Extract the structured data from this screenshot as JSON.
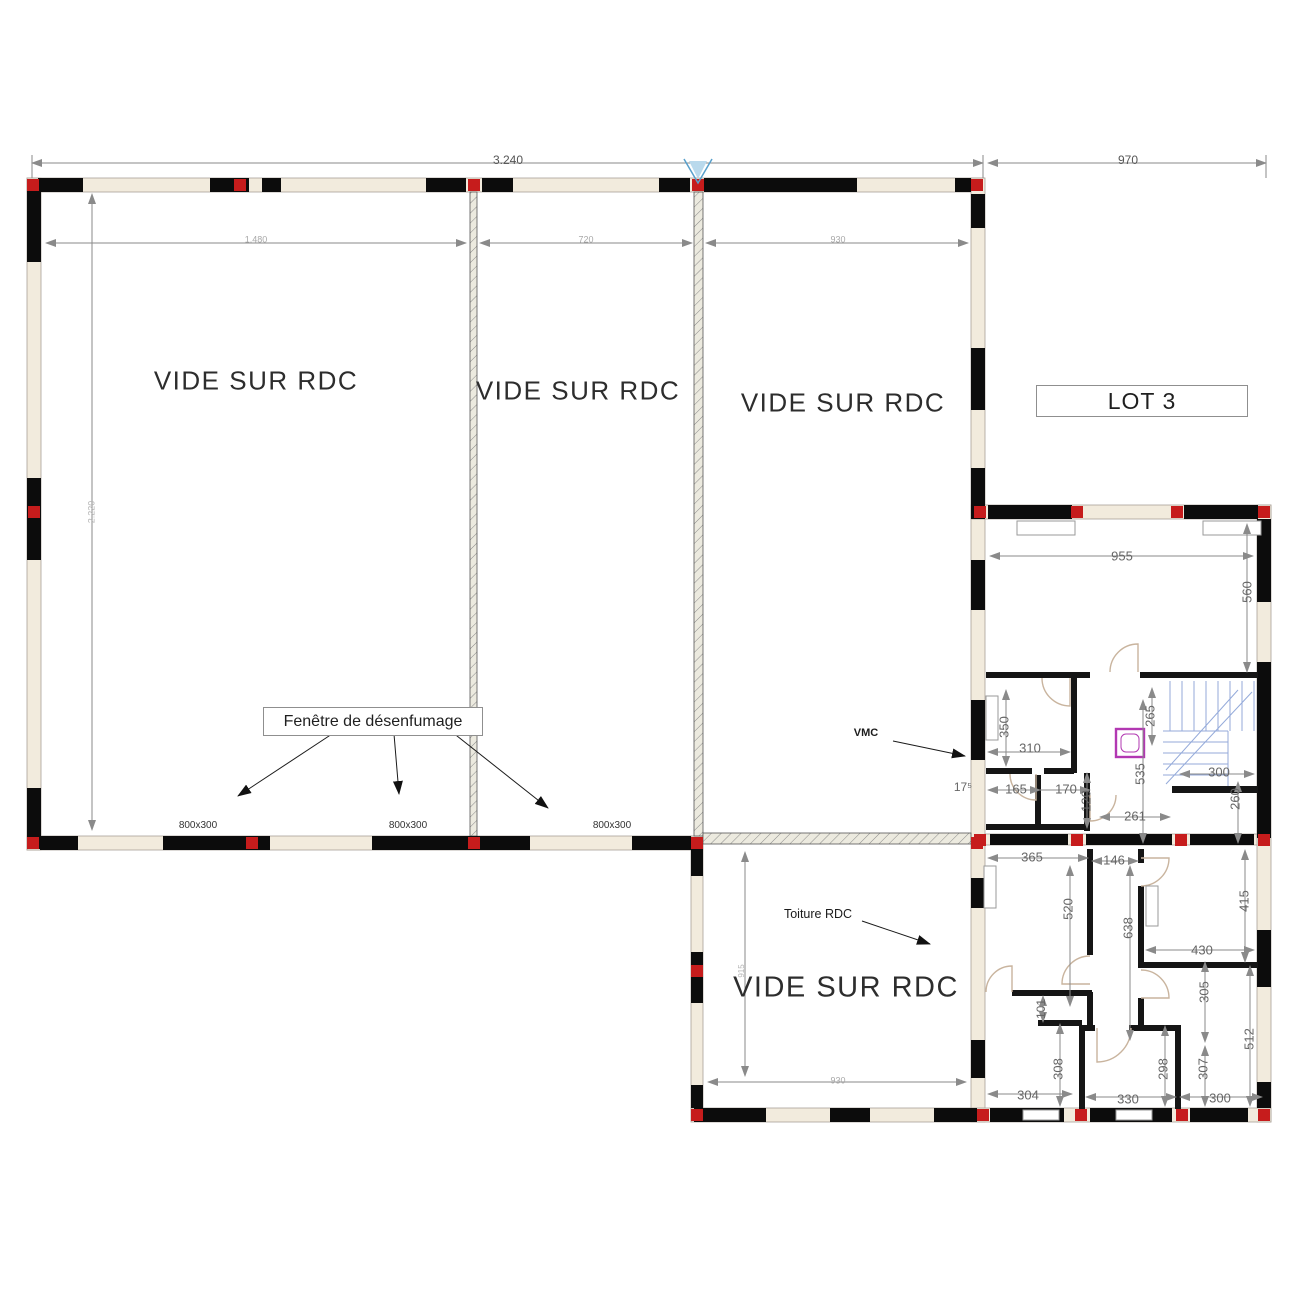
{
  "plan": {
    "area_labels": {
      "left": "VIDE SUR RDC",
      "middle": "VIDE SUR RDC",
      "right": "VIDE SUR RDC",
      "bottom": "VIDE SUR RDC"
    },
    "lot_label": "LOT 3",
    "callouts": {
      "smoke_window": "Fenêtre de désenfumage",
      "vmc": "VMC",
      "roof": "Toiture RDC"
    },
    "colors": {
      "wall_black": "#0c0c0c",
      "wall_infill": "#f2ebdd",
      "column_red": "#c61c1c",
      "dimension_gray": "#8a8a8a",
      "stairs_blue": "#94aada",
      "shaft_magenta": "#b238b2",
      "north_marker_blue": "#58a0cc"
    },
    "annotations": [
      {
        "n": "dim-overall-left",
        "t": "3.240",
        "x": 508,
        "y": 160,
        "s": 12,
        "c": "#555"
      },
      {
        "n": "dim-overall-right",
        "t": "970",
        "x": 1128,
        "y": 160,
        "s": 12,
        "c": "#555"
      },
      {
        "n": "dim-bay-1",
        "t": "1.480",
        "x": 256,
        "y": 240,
        "s": 9,
        "c": "#a8a8a8"
      },
      {
        "n": "dim-bay-2",
        "t": "720",
        "x": 586,
        "y": 240,
        "s": 9,
        "c": "#a8a8a8"
      },
      {
        "n": "dim-bay-3",
        "t": "930",
        "x": 838,
        "y": 240,
        "s": 9,
        "c": "#a8a8a8"
      },
      {
        "n": "dim-left-height",
        "t": "2.220",
        "x": 92,
        "y": 512,
        "r": -90,
        "s": 9,
        "c": "#b5b5b5"
      },
      {
        "n": "window-size-1",
        "t": "800x300",
        "x": 198,
        "y": 826,
        "s": 10,
        "c": "#333"
      },
      {
        "n": "window-size-2",
        "t": "800x300",
        "x": 408,
        "y": 826,
        "s": 10,
        "c": "#333"
      },
      {
        "n": "window-size-3",
        "t": "800x300",
        "x": 612,
        "y": 826,
        "s": 10,
        "c": "#333"
      },
      {
        "n": "dim-955",
        "t": "955",
        "x": 1122,
        "y": 556,
        "s": 13
      },
      {
        "n": "dim-560",
        "t": "560",
        "x": 1247,
        "y": 592,
        "r": -90,
        "s": 13
      },
      {
        "n": "dim-350",
        "t": "350",
        "x": 1004,
        "y": 727,
        "r": -90,
        "s": 13
      },
      {
        "n": "dim-310",
        "t": "310",
        "x": 1030,
        "y": 748,
        "s": 13
      },
      {
        "n": "dim-17-5",
        "t": "17⁵",
        "x": 963,
        "y": 787,
        "s": 12
      },
      {
        "n": "dim-165",
        "t": "165",
        "x": 1016,
        "y": 789,
        "s": 13
      },
      {
        "n": "dim-170",
        "t": "170",
        "x": 1066,
        "y": 789,
        "s": 13
      },
      {
        "n": "dim-120",
        "t": "120",
        "x": 1086,
        "y": 801,
        "r": -90,
        "s": 13
      },
      {
        "n": "dim-265",
        "t": "265",
        "x": 1150,
        "y": 716,
        "r": -90,
        "s": 13
      },
      {
        "n": "dim-535",
        "t": "535",
        "x": 1140,
        "y": 774,
        "r": -90,
        "s": 13
      },
      {
        "n": "dim-261",
        "t": "261",
        "x": 1135,
        "y": 816,
        "s": 13
      },
      {
        "n": "dim-300-stairs",
        "t": "300",
        "x": 1219,
        "y": 772,
        "s": 13
      },
      {
        "n": "dim-260",
        "t": "260",
        "x": 1235,
        "y": 799,
        "r": -90,
        "s": 13
      },
      {
        "n": "dim-365",
        "t": "365",
        "x": 1032,
        "y": 857,
        "s": 13
      },
      {
        "n": "dim-146",
        "t": "146",
        "x": 1114,
        "y": 860,
        "s": 13
      },
      {
        "n": "dim-520",
        "t": "520",
        "x": 1068,
        "y": 909,
        "r": -90,
        "s": 13
      },
      {
        "n": "dim-638",
        "t": "638",
        "x": 1128,
        "y": 928,
        "r": -90,
        "s": 13
      },
      {
        "n": "dim-415",
        "t": "415",
        "x": 1244,
        "y": 901,
        "r": -90,
        "s": 13
      },
      {
        "n": "dim-430",
        "t": "430",
        "x": 1202,
        "y": 950,
        "s": 13
      },
      {
        "n": "dim-305",
        "t": "305",
        "x": 1204,
        "y": 992,
        "r": -90,
        "s": 13
      },
      {
        "n": "dim-512",
        "t": "512",
        "x": 1249,
        "y": 1039,
        "r": -90,
        "s": 13
      },
      {
        "n": "dim-101",
        "t": "101",
        "x": 1041,
        "y": 1009,
        "r": -90,
        "s": 12
      },
      {
        "n": "dim-308",
        "t": "308",
        "x": 1058,
        "y": 1069,
        "r": -90,
        "s": 13
      },
      {
        "n": "dim-298",
        "t": "298",
        "x": 1163,
        "y": 1069,
        "r": -90,
        "s": 13
      },
      {
        "n": "dim-307",
        "t": "307",
        "x": 1203,
        "y": 1069,
        "r": -90,
        "s": 13
      },
      {
        "n": "dim-304",
        "t": "304",
        "x": 1028,
        "y": 1095,
        "s": 13
      },
      {
        "n": "dim-330",
        "t": "330",
        "x": 1128,
        "y": 1099,
        "s": 13
      },
      {
        "n": "dim-300-bottom",
        "t": "300",
        "x": 1220,
        "y": 1098,
        "s": 13
      },
      {
        "n": "dim-930-bottom",
        "t": "930",
        "x": 838,
        "y": 1081,
        "s": 9,
        "c": "#a8a8a8"
      },
      {
        "n": "dim-915-bottom",
        "t": "915",
        "x": 742,
        "y": 971,
        "r": -90,
        "s": 8,
        "c": "#b5b5b5"
      }
    ]
  }
}
